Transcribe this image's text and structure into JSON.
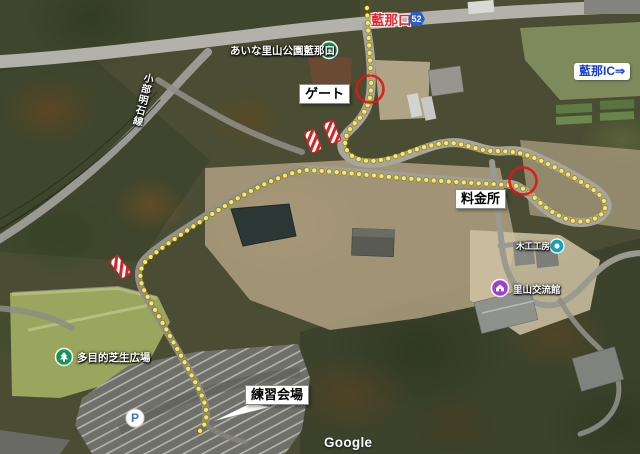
{
  "map_annotations": {
    "road_badge": {
      "number": "52"
    },
    "labels": {
      "exit_name": "藍那口",
      "park_entrance": "あいな里山公園藍那口",
      "road_name": "小部明石線",
      "gate": "ゲート",
      "interchange": "藍那IC⇒",
      "toll_booth": "料金所",
      "wood_workshop": "木工工房",
      "satoyama_hall": "里山交流館",
      "lawn_plaza": "多目的芝生広場",
      "practice_venue": "練習会場"
    },
    "icons": {
      "parking": "P"
    },
    "attribution": "Google",
    "colors": {
      "route_dots": "#ffe94f",
      "highlight_circle": "#e01616",
      "exit_text": "#e8262d",
      "interchange_text": "#1a3fd4",
      "badge_blue": "#2b5fc7"
    }
  }
}
